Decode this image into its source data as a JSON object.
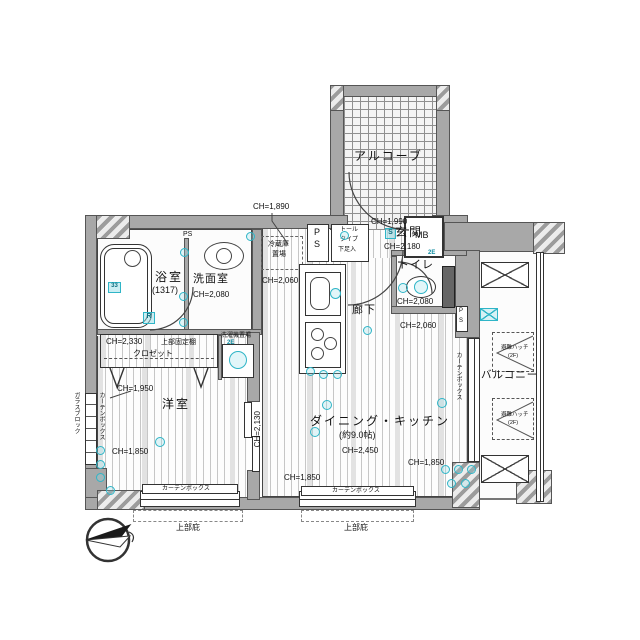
{
  "colors": {
    "teal": "#2fb5c7",
    "wall_gray": "#a8a8a8",
    "line": "#333333"
  },
  "labels": {
    "ch_1890": "CH=1,890",
    "alcove": "アルコーブ",
    "mb": "MB",
    "entrance": "玄関",
    "ch_1990": "CH=1,990",
    "ch_2180": "CH=2,180",
    "shoe_l1": "トール",
    "shoe_l2": "タイプ",
    "shoe_l3": "下足入",
    "ps_p": "P",
    "ps_s": "S",
    "ps": "PS",
    "fridge_l1": "冷蔵庫",
    "fridge_l2": "置場",
    "bath": "浴室",
    "bath_size": "(1317)",
    "washroom": "洗面室",
    "ch_2080": "CH=2,080",
    "toilet": "トイレ",
    "hallway": "廊下",
    "ch_2060": "CH=2,060",
    "ch_2330": "CH=2,330",
    "shelf": "上部固定棚",
    "closet": "クロゼット",
    "washer": "洗濯機置場",
    "west_room": "洋室",
    "ch_1950": "CH=1,950",
    "dk": "ダイニング・キッチン",
    "dk_size": "(約9.0帖)",
    "ch_2450": "CH=2,450",
    "ch_2130": "CH=2,130",
    "ch_1850": "CH=1,850",
    "curtain_box": "カーテンボックス",
    "eaves": "上部庇",
    "balcony": "バルコニー",
    "hatch_l1": "避難ハッチ",
    "hatch_l2": "(2F)",
    "glass_block": "ガラスブロック",
    "mark_2e": "2E",
    "mark_r": "R",
    "mark_s": "S"
  }
}
